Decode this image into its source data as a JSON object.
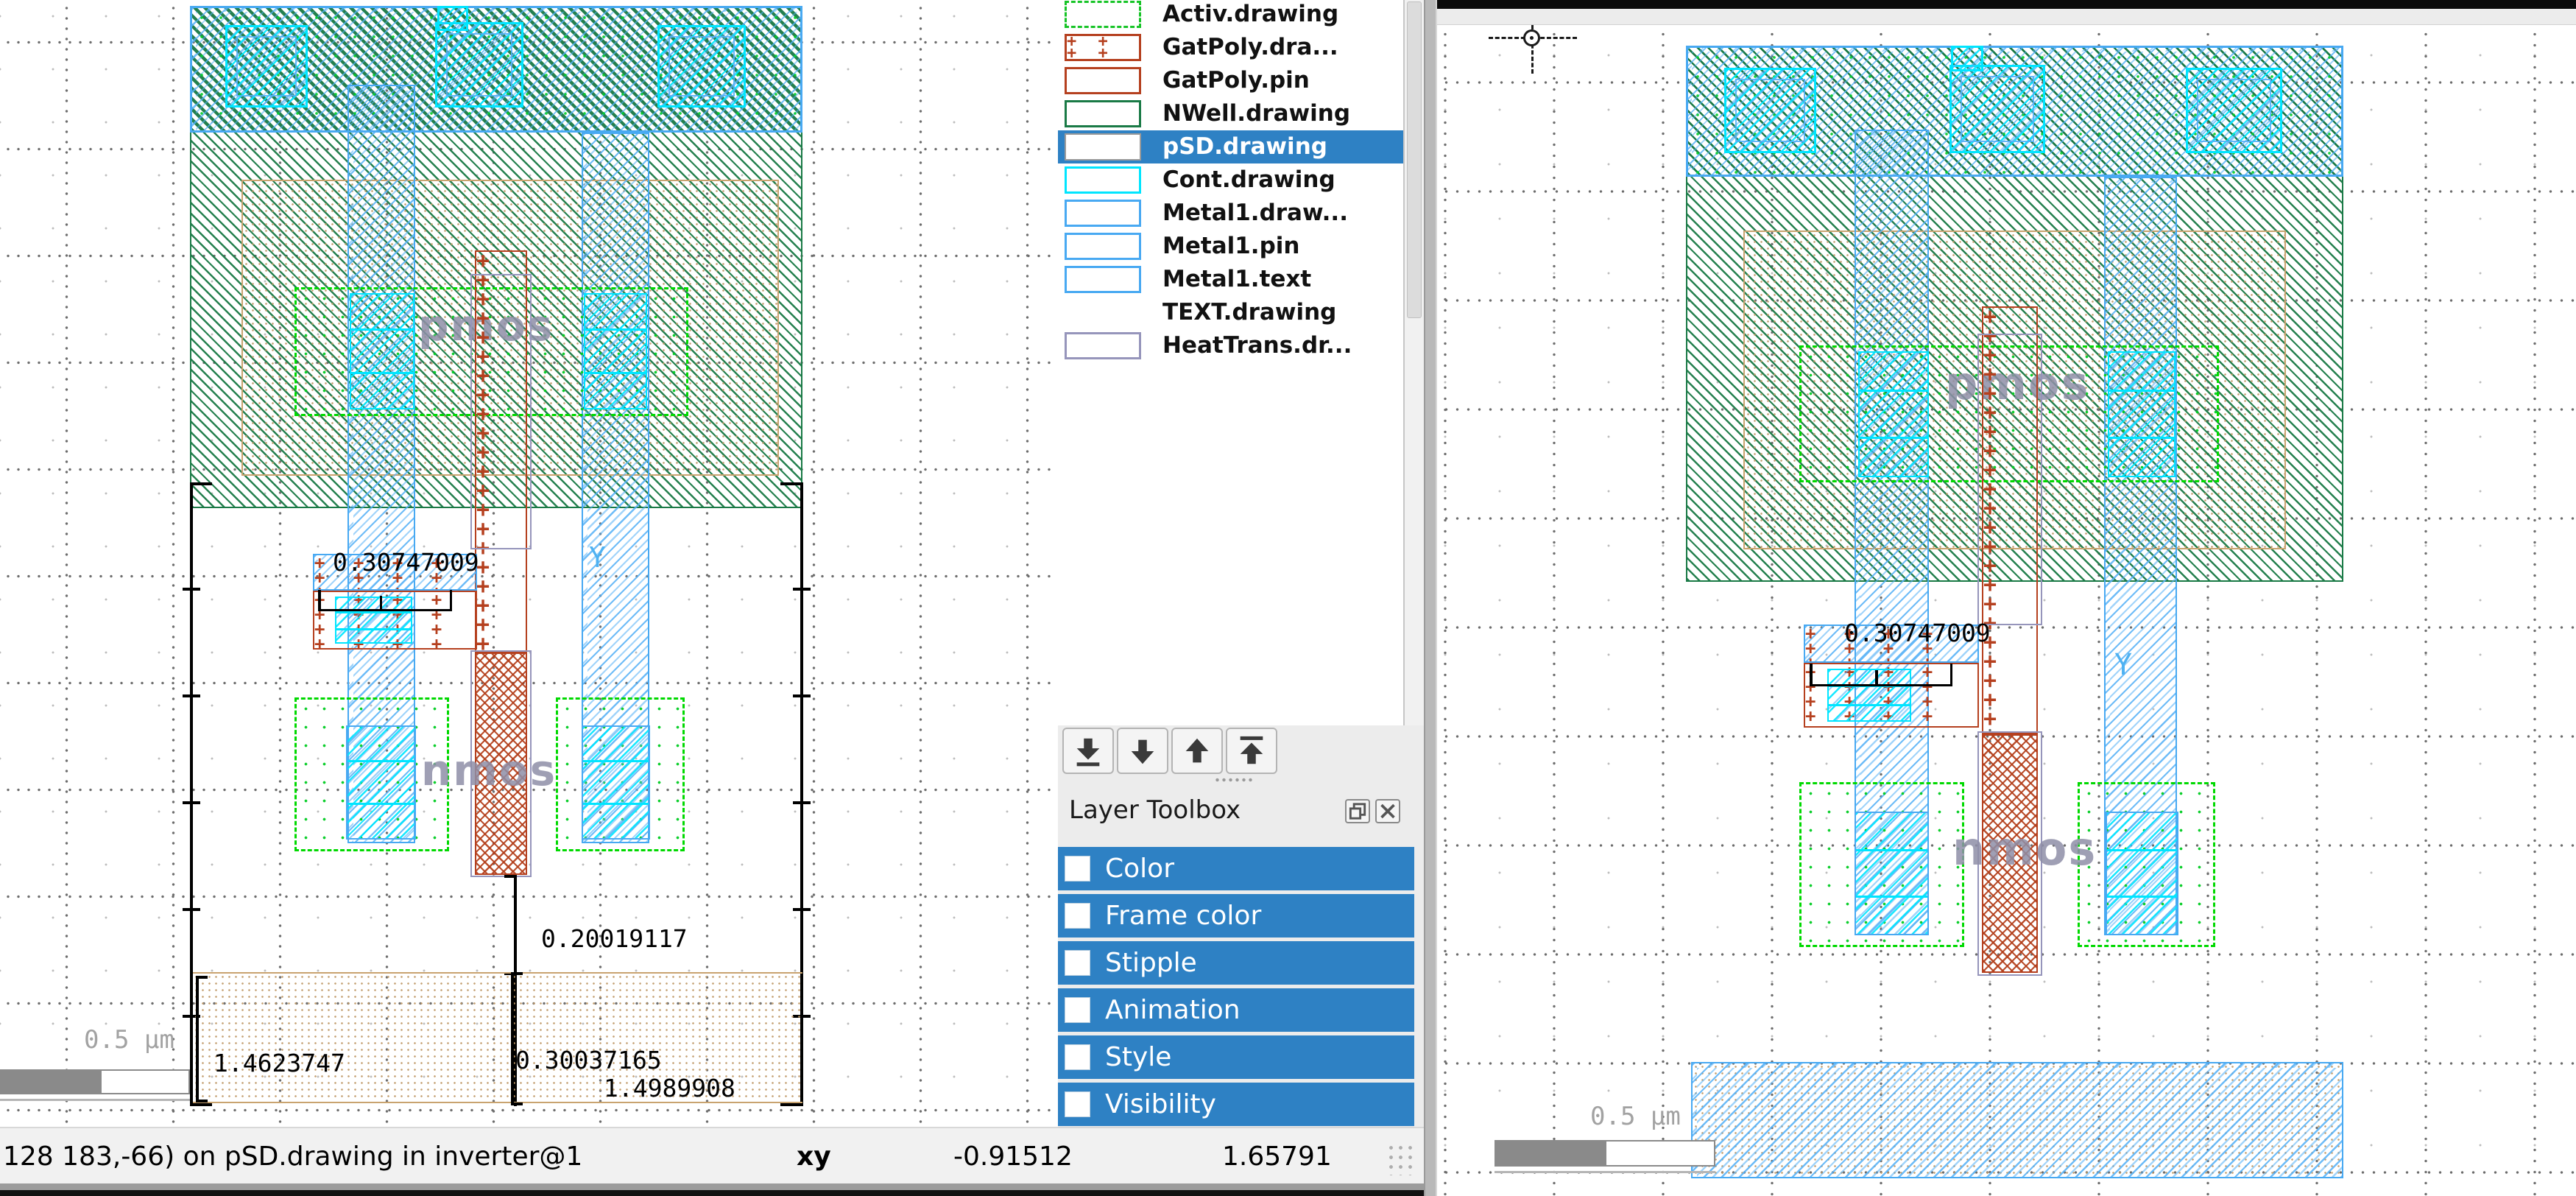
{
  "layer_panel": {
    "items": [
      {
        "label": "Activ.drawing",
        "selected": false
      },
      {
        "label": "GatPoly.dra...",
        "selected": false
      },
      {
        "label": "GatPoly.pin",
        "selected": false
      },
      {
        "label": "NWell.drawing",
        "selected": false
      },
      {
        "label": "pSD.drawing",
        "selected": true
      },
      {
        "label": "Cont.drawing",
        "selected": false
      },
      {
        "label": "Metal1.draw...",
        "selected": false
      },
      {
        "label": "Metal1.pin",
        "selected": false
      },
      {
        "label": "Metal1.text",
        "selected": false
      },
      {
        "label": "TEXT.drawing",
        "selected": false
      },
      {
        "label": "HeatTrans.dr...",
        "selected": false
      }
    ],
    "selected_color": "#2e81c4"
  },
  "layer_toolbox": {
    "title": "Layer Toolbox",
    "rows": [
      "Color",
      "Frame color",
      "Stipple",
      "Animation",
      "Style",
      "Visibility"
    ],
    "row_color": "#2e81c4"
  },
  "left_view": {
    "cell_labels": {
      "pmos": "pmos",
      "nmos": "nmos",
      "metal_text": "Y"
    },
    "measurements": {
      "contact_width": "0.30747009",
      "gate_extension": "0.20019117",
      "psd_left": "1.4623747",
      "psd_mid": "0.30037165",
      "psd_total": "1.4989908"
    },
    "scale_label": "0.5 µm"
  },
  "right_view": {
    "cell_labels": {
      "pmos": "pmos",
      "nmos": "nmos",
      "metal_text": "Y"
    },
    "measurements": {
      "contact_width": "0.30747009"
    },
    "scale_label": "0.5 µm"
  },
  "status_bar": {
    "message": "128 183,-66) on pSD.drawing in inverter@1",
    "xy_label": "xy",
    "x_value": "-0.91512",
    "y_value": "1.65791"
  },
  "colors": {
    "nwell": "#1a7a46",
    "activ": "#00cc22",
    "gatpoly": "#b5401f",
    "cont": "#00e5ff",
    "metal1": "#48a9f2",
    "psd_tan": "#c9a36f",
    "heattrans": "#9695bb",
    "selection_blue": "#2e81c4"
  }
}
